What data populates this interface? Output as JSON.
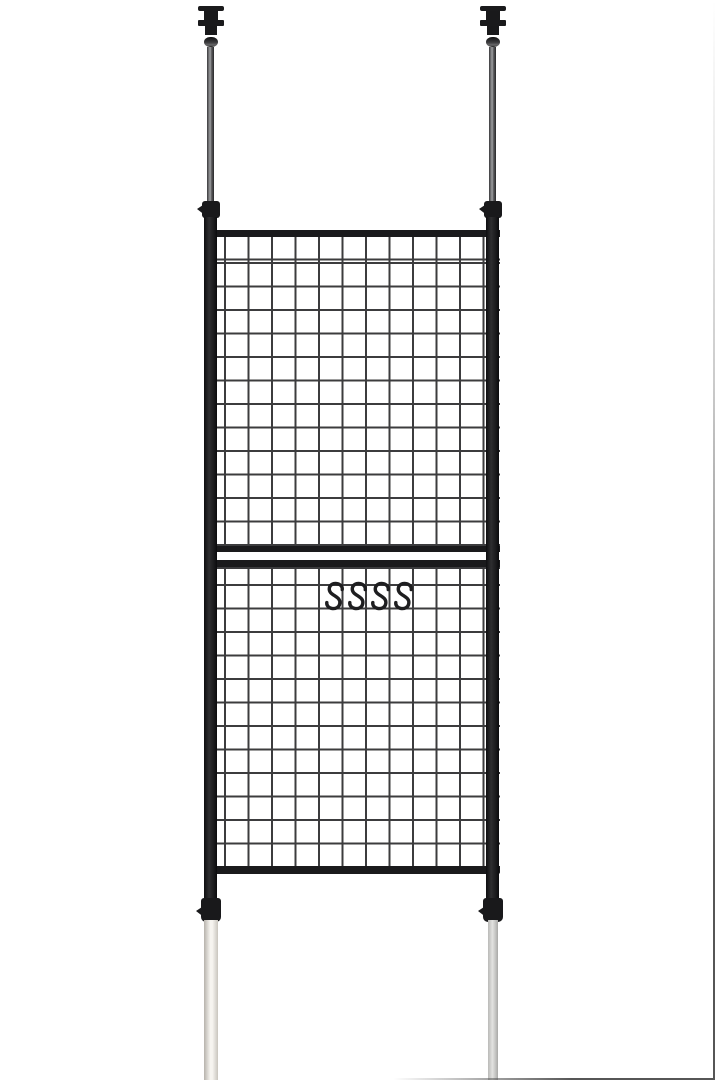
{
  "meta": {
    "content_type": "product-photo",
    "description": "Floor-to-ceiling tension-pole wire mesh partition panel (two stacked grid sections between two black poles) with four black S-hooks hanging on the lower grid, on a plain white background",
    "visible_text": ""
  },
  "scene": {
    "background_color": "#ffffff",
    "edge_border_color": "#565656",
    "frame_color": "#1a1a1c",
    "clamp_color": "#19191b",
    "mesh_wire_color": "#3c3c3e",
    "hook_color": "#1e1e20",
    "bottom_pole_left_colors": {
      "edge": "#b7b3ac",
      "mid": "#f6f4f0",
      "shade": "#c9c5be"
    },
    "bottom_pole_right_colors": {
      "edge": "#b9b9b7",
      "mid": "#e3e3e1",
      "shade": "#a9a9a7"
    },
    "s_hooks": {
      "count": 4,
      "spacing_px": 23,
      "first_left_px": 322
    },
    "mesh": {
      "columns": 12,
      "upper_rows": 13,
      "lower_rows": 12,
      "cell_px": 23.5
    },
    "parts": [
      {
        "name": "ceiling-mount-cap-left",
        "description": "ceiling pressure cap, left pole"
      },
      {
        "name": "ceiling-mount-cap-right",
        "description": "ceiling pressure cap, right pole"
      },
      {
        "name": "upper-tension-pole-left",
        "description": "thin telescoping rod to ceiling, left"
      },
      {
        "name": "upper-tension-pole-right",
        "description": "thin telescoping rod to ceiling, right"
      },
      {
        "name": "height-clamp-top-left",
        "description": "adjustment clamp with knob, upper left"
      },
      {
        "name": "height-clamp-top-right",
        "description": "adjustment clamp with knob, upper right"
      },
      {
        "name": "side-frame-pole-left",
        "description": "black vertical frame pole, left"
      },
      {
        "name": "side-frame-pole-right",
        "description": "black vertical frame pole, right"
      },
      {
        "name": "wire-mesh-panel-upper",
        "description": "upper wire grid section"
      },
      {
        "name": "wire-mesh-panel-lower",
        "description": "lower wire grid section"
      },
      {
        "name": "panel-divider",
        "description": "horizontal divider bars between grid sections"
      },
      {
        "name": "s-hooks",
        "description": "four S-shaped hooks hanging on lower grid wire"
      },
      {
        "name": "height-clamp-bottom-left",
        "description": "adjustment clamp with knob, lower left"
      },
      {
        "name": "height-clamp-bottom-right",
        "description": "adjustment clamp with knob, lower right"
      },
      {
        "name": "bottom-extension-pole-left",
        "description": "ivory/white floor extension pole, left"
      },
      {
        "name": "bottom-extension-pole-right",
        "description": "light gray floor extension pole, right"
      }
    ]
  }
}
